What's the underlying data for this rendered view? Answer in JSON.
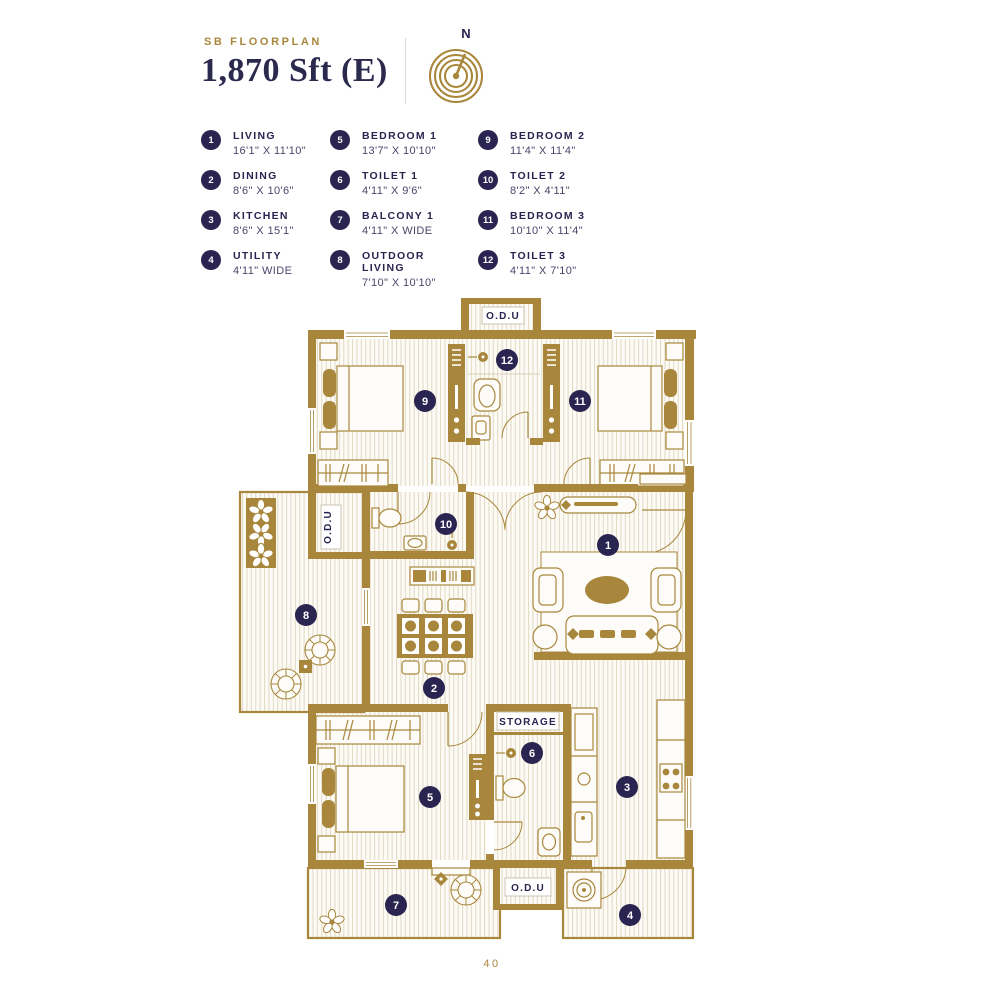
{
  "header": {
    "eyebrow": "SB FLOORPLAN",
    "title": "1,870 Sft (E)",
    "compass_label": "N"
  },
  "legend": {
    "items": [
      {
        "number": "1",
        "name": "LIVING",
        "dims": "16'1\" X 11'10\""
      },
      {
        "number": "2",
        "name": "DINING",
        "dims": "8'6\" X 10'6\""
      },
      {
        "number": "3",
        "name": "KITCHEN",
        "dims": "8'6\" X 15'1\""
      },
      {
        "number": "4",
        "name": "UTILITY",
        "dims": "4'11\" WIDE"
      },
      {
        "number": "5",
        "name": "BEDROOM 1",
        "dims": "13'7\" X 10'10\""
      },
      {
        "number": "6",
        "name": "TOILET 1",
        "dims": "4'11\" X 9'6\""
      },
      {
        "number": "7",
        "name": "BALCONY 1",
        "dims": "4'11\" X WIDE"
      },
      {
        "number": "8",
        "name": "OUTDOOR LIVING",
        "dims": "7'10\" X 10'10\""
      },
      {
        "number": "9",
        "name": "BEDROOM 2",
        "dims": "11'4\" X 11'4\""
      },
      {
        "number": "10",
        "name": "TOILET 2",
        "dims": "8'2\" X 4'11\""
      },
      {
        "number": "11",
        "name": "BEDROOM 3",
        "dims": "10'10\" X 11'4\""
      },
      {
        "number": "12",
        "name": "TOILET 3",
        "dims": "4'11\" X 7'10\""
      }
    ]
  },
  "plan": {
    "labels": {
      "odu_top": "O.D.U",
      "odu_middle": "O.D.U",
      "odu_bottom": "O.D.U",
      "storage": "STORAGE"
    }
  },
  "footer": {
    "page_number": "40"
  },
  "colors": {
    "accent_gold": "#A8873C",
    "navy": "#2A2450",
    "floor_stripe": "#E4DBC6"
  }
}
